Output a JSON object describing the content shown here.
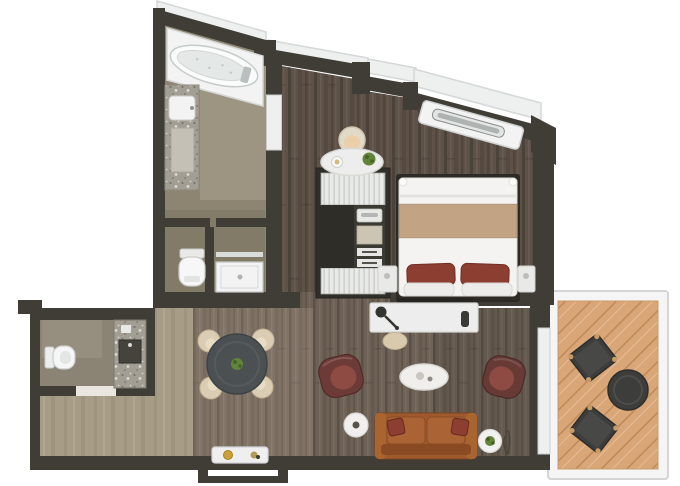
{
  "plan": {
    "kind": "hotel-suite-floor-plan",
    "rooms": [
      {
        "id": "bathroom",
        "features": [
          "bathtub",
          "vanity-sink",
          "toilet",
          "shower"
        ]
      },
      {
        "id": "bedroom",
        "features": [
          "double-bed",
          "nightstand-left",
          "nightstand-right",
          "desk-tray",
          "desk-chair",
          "kitchenette-closet",
          "window-bench"
        ]
      },
      {
        "id": "living-room",
        "features": [
          "dining-table",
          "dining-chairs",
          "armchair-left",
          "armchair-right",
          "coffee-table",
          "sofa",
          "side-tables",
          "tv-console",
          "lamp",
          "pouf"
        ]
      },
      {
        "id": "powder-room",
        "features": [
          "toilet",
          "vanity-sink"
        ]
      },
      {
        "id": "hallway",
        "features": [
          "entry-console"
        ]
      },
      {
        "id": "balcony",
        "features": [
          "outdoor-chair",
          "outdoor-chair",
          "outdoor-table"
        ]
      }
    ],
    "counts": {
      "dining_chairs": 4,
      "armchairs": 2,
      "balcony_chairs": 2,
      "bed_pillows": 2,
      "sofa_pillows": 2
    }
  },
  "colors": {
    "background": "#ffffff",
    "wall": "#3f3d36",
    "wall_dark": "#2f2e29",
    "bathroom_floor": "#8d8571",
    "bedroom_floor": "#5e5248",
    "living_floor": "#6e6156",
    "hallway_floor": "#a79d87",
    "wc_floor": "#8b8373",
    "balcony_deck": "#d9a678",
    "balcony_frame": "#f4f5f4",
    "fixture_white": "#f2f3f2",
    "marble": "#a39e94",
    "glass_white": "#eef0ef",
    "bed_duvet": "#f4f3f1",
    "bed_blanket": "#c2a384",
    "pillow_maroon": "#8c3e31",
    "armchair": "#6d3b37",
    "armchair_seat": "#8d4b44",
    "sofa": "#9e5a2e",
    "sofa_cushion": "#a96335",
    "sofa_back": "#8a4a24",
    "dining_table": "#4b5053",
    "chair_cream": "#dbcdb3",
    "desk_white": "#ecedec",
    "plant_green": "#628439",
    "accent_gold": "#c9a23a",
    "outdoor_furniture": "#3d3d3b",
    "window_trim": "#d5d8d7"
  }
}
